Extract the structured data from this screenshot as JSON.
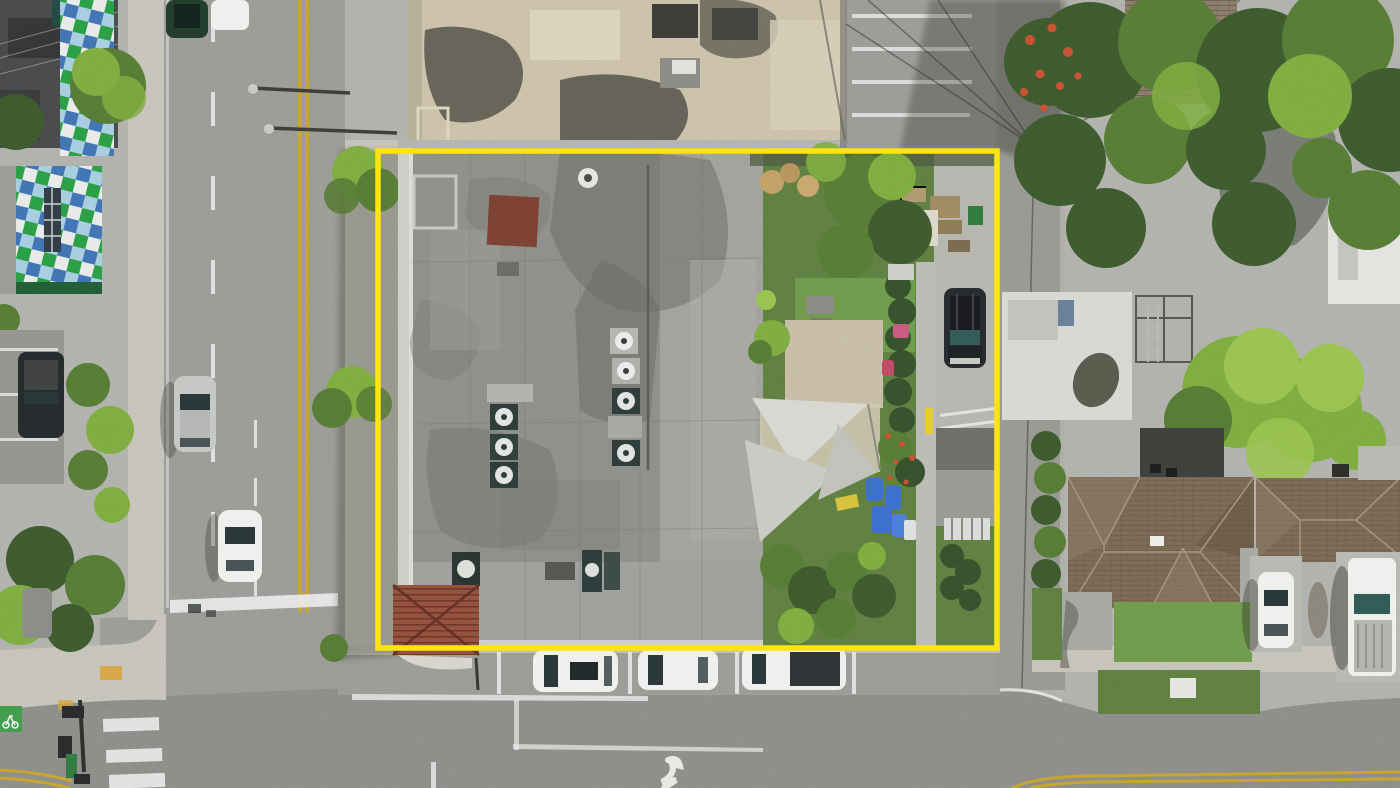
{
  "image": {
    "kind": "aerial-drone-photo",
    "width": 1400,
    "height": 788,
    "subject": "commercial corner property outlined in yellow, flat gray roof building with rooftop HVAC, rear yard with shade sails, surrounded by streets, parked cars, trees and neighboring houses"
  },
  "boundary": {
    "x": 378,
    "y": 151,
    "width": 619,
    "height": 497,
    "stroke_width": 5.5
  },
  "inventory": {
    "property_boundary": "yellow rectangle annotation",
    "main_building": "large flat gray roof with HVAC units, vents and rust-red patch",
    "rear_yard": "turf lawn, paver patio, white shade sails, blue bins, hedges, driveway with dark SUV, shed",
    "north_building": "beige flat roof with stains and AC units",
    "northeast_parking": "striped parking lot with utility pole and wires",
    "west_street": "two-way road, double yellow centerline, dashed lane lines, crosswalk, green bike lane, traffic signals",
    "south_street": "road with stop lines, turn arrow, three head-in parked white vehicles, red tile entry roof",
    "west_block": "buildings with green-blue checkered mural roofs, parking lot with dark SUV, palms and bushes",
    "east_block": "dense tree canopy, red flowering tree, brick and white roofs, two brown shingle houses, white sedan and pickup in driveways"
  },
  "vehicle_counts": {
    "south_parked_white": 3,
    "west_street": 4,
    "west_lot": 1,
    "yard_driveway": 1,
    "east_driveways": 2
  },
  "colors": {
    "ground": "#b2b3ae",
    "asphalt": "#9c9d99",
    "asphalt_dark": "#8e8f8a",
    "concrete": "#c7c5bc",
    "concrete_bright": "#d9d7cd",
    "roof_gray": "#8f908c",
    "roof_gray_light": "#a7a8a3",
    "parapet": "#cfd0cb",
    "roof_beige": "#cdc3a9",
    "roof_dark": "#47494a",
    "rust": "#7c4030",
    "tile_red": "#96503c",
    "tile_dark": "#6e3526",
    "lawn": "#5f8040",
    "turf": "#6f9c4a",
    "tree_dark": "#3b5a2b",
    "tree_mid": "#567c33",
    "tree_bright": "#7fae3e",
    "tree_lime": "#9ac44f",
    "hedge": "#33512a",
    "flower": "#c9502f",
    "boundary": "#ffe60a",
    "lane_yellow": "#c8a52e",
    "lane_white": "#eceded",
    "sail": "#d9d9d4",
    "bin_blue": "#3a6fd0",
    "mural_green": "#27a044",
    "mural_blue": "#3f74b5",
    "mural_sky": "#a9cfe2",
    "mural_white": "#e9ecea",
    "car_white": "#f1f2ef",
    "car_silver": "#c6c9c5",
    "car_dark": "#24282a",
    "glass": "#273538",
    "glass_teal": "#2e5a55",
    "sign_green": "#2f7a3f",
    "bike_green": "#3f9e4a",
    "shingle": "#7b6a55",
    "shingle_light": "#8e7c65",
    "shingle_dark": "#5f4e3d",
    "shadow": "#23251f"
  }
}
